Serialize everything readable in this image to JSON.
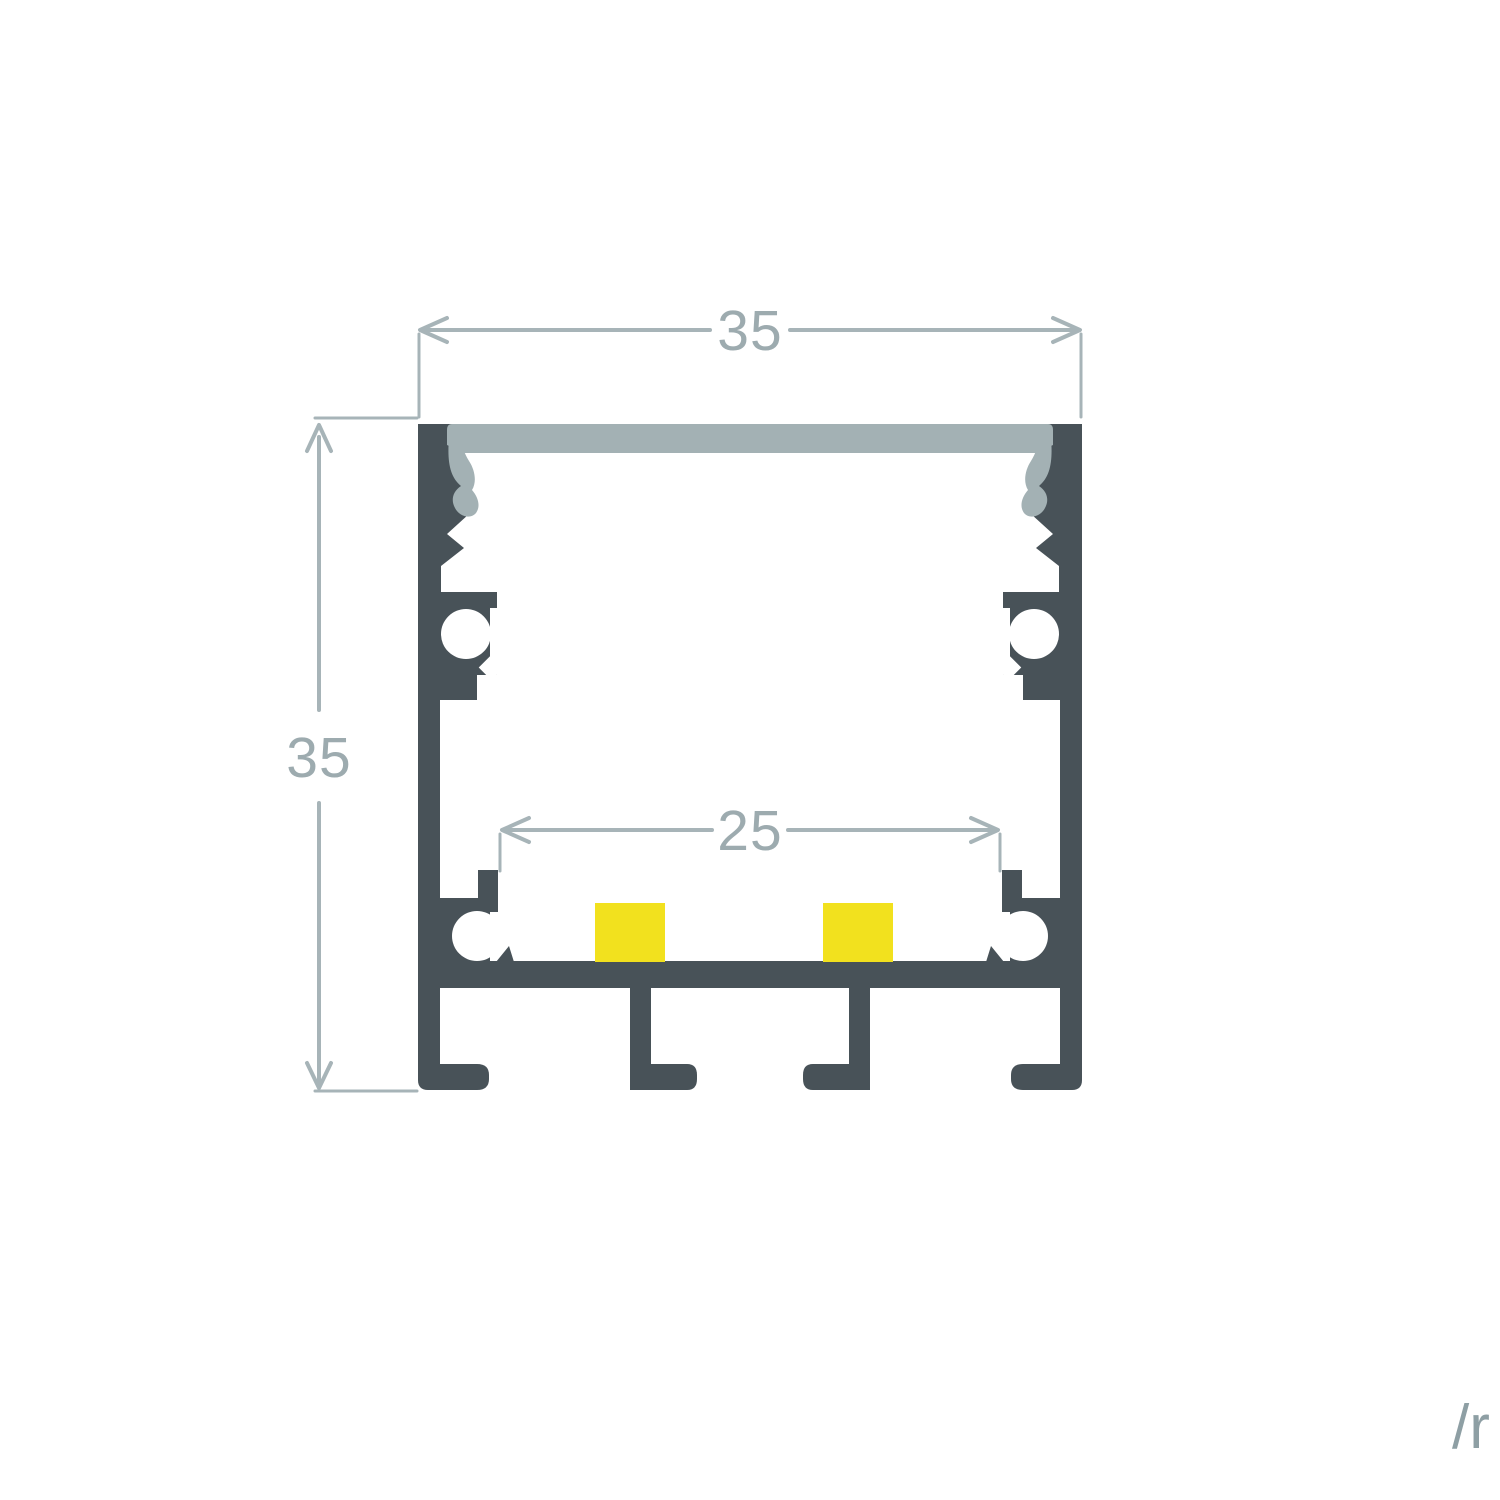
{
  "page": {
    "background": "#ffffff",
    "watermark": "/r"
  },
  "diagram": {
    "type": "technical-cross-section",
    "subject": "surface-mounted aluminium LED strip profile with opal diffuser, screw bosses, LED strip and mounting channels",
    "colors": {
      "profile_body": "#485258",
      "diffuser": "#A3B1B4",
      "led_strip": "#F2E11E",
      "dimension_line": "#A7B4B8",
      "dimension_text": "#9DABAF",
      "watermark_text": "#8E9FA4"
    },
    "led_pad_count": 2,
    "dimensions": {
      "outer_width": {
        "value": "35",
        "orientation": "horizontal",
        "position": "top"
      },
      "outer_height": {
        "value": "35",
        "orientation": "vertical",
        "position": "left"
      },
      "inner_width": {
        "value": "25",
        "orientation": "horizontal",
        "position": "inner"
      }
    }
  }
}
